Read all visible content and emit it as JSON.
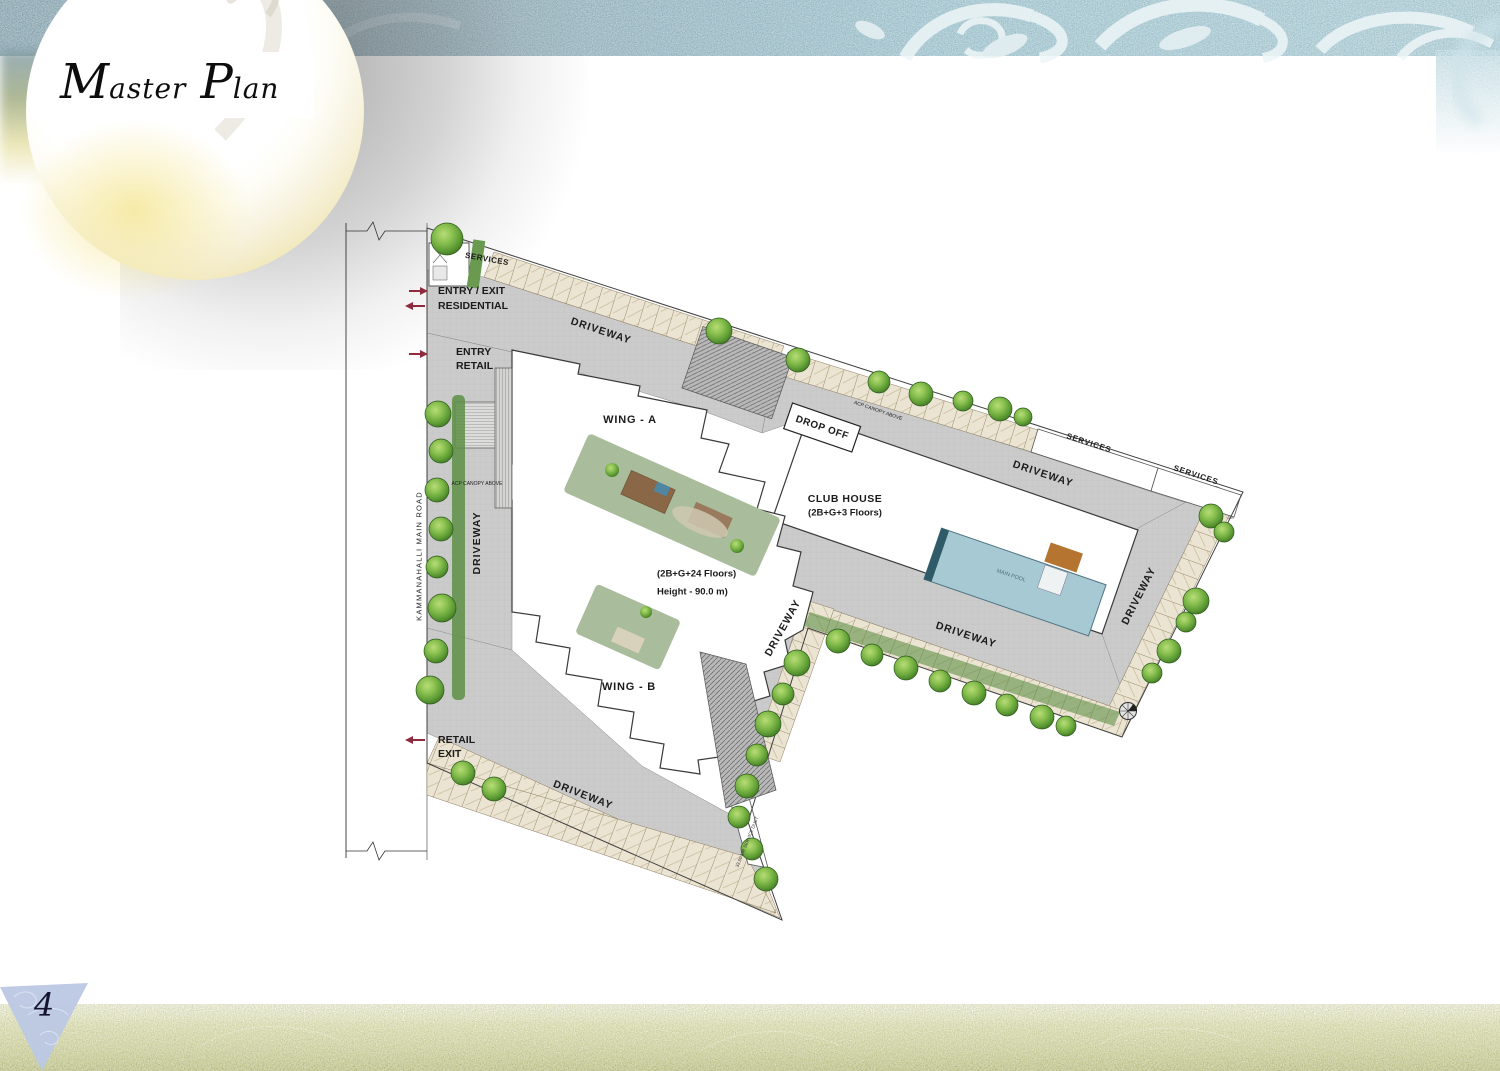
{
  "header": {
    "title_full": "Master Plan",
    "title_cap1": "M",
    "title_rest1": "aster",
    "title_cap2": "P",
    "title_rest2": "lan"
  },
  "footer": {
    "page_number": "4"
  },
  "plan": {
    "labels": [
      {
        "text": "SERVICES"
      },
      {
        "text": "ENTRY / EXIT"
      },
      {
        "text": "RESIDENTIAL"
      },
      {
        "text": "ENTRY"
      },
      {
        "text": "RETAIL"
      },
      {
        "text": "DRIVEWAY"
      },
      {
        "text": "KAMMANAHALLI MAIN ROAD"
      },
      {
        "text": "ACP CANOPY ABOVE"
      },
      {
        "text": "DRIVEWAY"
      },
      {
        "text": "WING - A"
      },
      {
        "text": "DROP OFF"
      },
      {
        "text": "ACP CANOPY ABOVE"
      },
      {
        "text": "SERVICES"
      },
      {
        "text": "SERVICES"
      },
      {
        "text": "DRIVEWAY"
      },
      {
        "text": "CLUB HOUSE"
      },
      {
        "text": "(2B+G+3 Floors)"
      },
      {
        "text": "MAIN POOL"
      },
      {
        "text": "DRIVEWAY"
      },
      {
        "text": "DRIVEWAY"
      },
      {
        "text": "(2B+G+24 Floors)"
      },
      {
        "text": "Height - 90.0 m)"
      },
      {
        "text": "DRIVEWAY"
      },
      {
        "text": "WING - B"
      },
      {
        "text": "RETAIL"
      },
      {
        "text": "EXIT"
      },
      {
        "text": "DRIVEWAY"
      },
      {
        "text": "33.50 MR SERVICE DUCT"
      }
    ]
  },
  "colors": {
    "band_teal": "#9fc2cd",
    "band_olive": "#b3b96d",
    "driveway_gray": "#cacbca",
    "tree_green": "#66a83d",
    "pool_blue": "#a7c9d4",
    "arrow_red": "#8e2b3c",
    "stall_beige": "#ebe4d2",
    "triangle_blue": "#bcc8e4"
  }
}
